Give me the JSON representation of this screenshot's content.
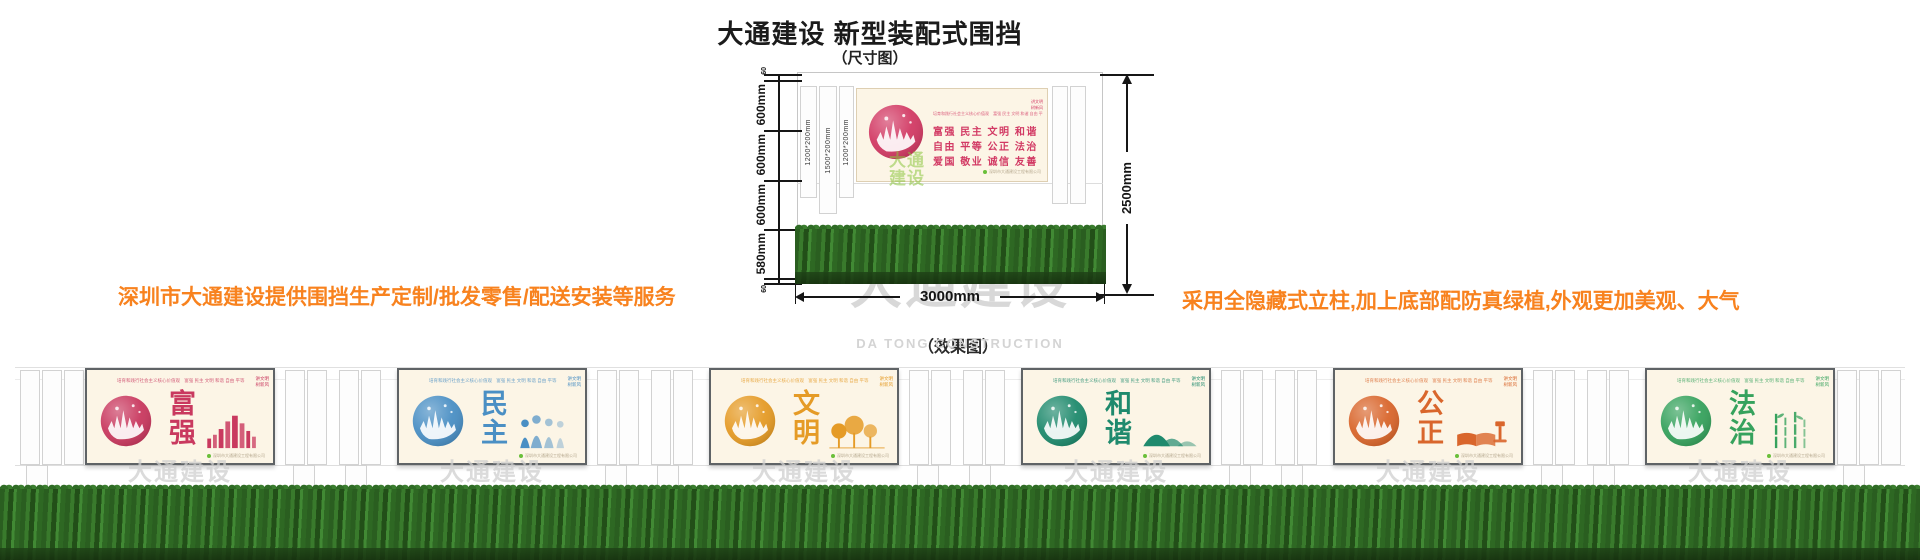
{
  "header": {
    "title": "大通建设 新型装配式围挡",
    "subtitle": "（尺寸图）"
  },
  "notes": {
    "left": "深圳市大通建设提供围挡生产定制/批发零售/配送安装等服务",
    "right": "采用全隐藏式立柱,加上底部配防真绿植,外观更加美观、大气",
    "color": "#f8821e"
  },
  "effect_label": "（效果图）",
  "watermark": {
    "cn": "大通建设",
    "en": "DA TONG CONSTRUCTION"
  },
  "diagram": {
    "total_height": "2500mm",
    "width": "3000mm",
    "heights": [
      "60",
      "600mm",
      "600mm",
      "600mm",
      "580mm",
      "60"
    ],
    "posts": [
      "1200*200mm",
      "1500*200mm",
      "1200*200mm"
    ],
    "billboard": {
      "accent": "#d23a64",
      "slogan": "培育和践行社会主义核心价值观",
      "values_inline": "富强 民主 文明 和谐 自由 平等 公正 法治 爱国 敬业 诚信 友善",
      "rows": [
        "富强  民主  文明  和谐",
        "自由  平等  公正  法治",
        "爱国  敬业  诚信  友善"
      ],
      "corner_line1": "讲文明",
      "corner_line2": "树新风",
      "footer": "深圳市大通建设工程有限公司"
    }
  },
  "effect_panels": [
    {
      "word": "富强",
      "color": "#c9395f"
    },
    {
      "word": "民主",
      "color": "#4a8fc4"
    },
    {
      "word": "文明",
      "color": "#e59b26"
    },
    {
      "word": "和谐",
      "color": "#1f8a6d"
    },
    {
      "word": "公正",
      "color": "#d9662c"
    },
    {
      "word": "法治",
      "color": "#36a25d"
    }
  ]
}
